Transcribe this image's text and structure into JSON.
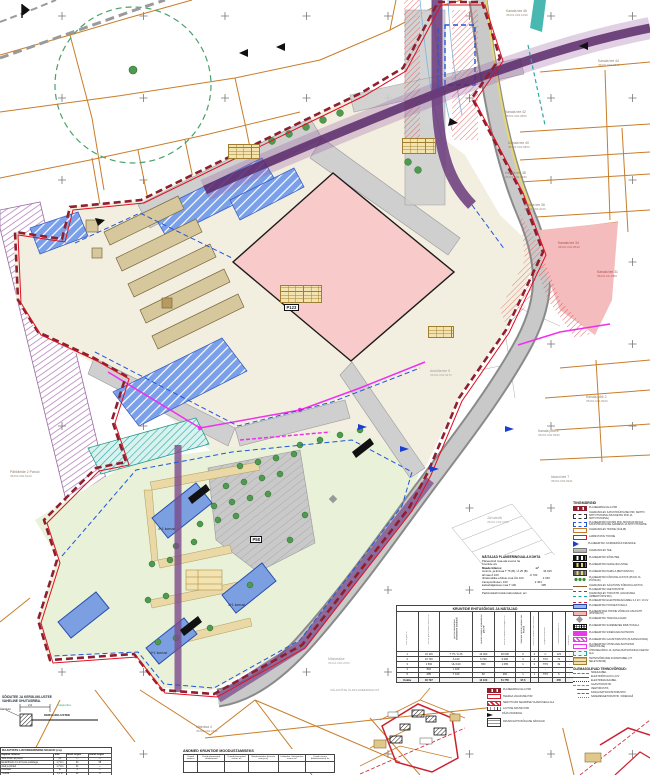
{
  "map": {
    "north_label": "s",
    "parcel_labels": [
      {
        "text": "Kanala tee 46",
        "sub": "35201:004:1090",
        "x": 506,
        "y": 10,
        "color": "#8a7a6a"
      },
      {
        "text": "Kanala tee 44",
        "sub": "35201:004:0870",
        "x": 598,
        "y": 60,
        "color": "#8a7a6a"
      },
      {
        "text": "Kanala tee 42",
        "sub": "35201:004:0850",
        "x": 505,
        "y": 111,
        "color": "#8a7a6a"
      },
      {
        "text": "Kanala tee 40",
        "sub": "35201:004:0860",
        "x": 508,
        "y": 142,
        "color": "#8a7a6a"
      },
      {
        "text": "Kanala tee 38",
        "sub": "35201:004:1580",
        "x": 505,
        "y": 172,
        "color": "#8a7a6a"
      },
      {
        "text": "Kanala tee 36",
        "sub": "35201:004:2020",
        "x": 524,
        "y": 204,
        "color": "#8a7a6a"
      },
      {
        "text": "Kanala tee 34",
        "sub": "35201:004:0540",
        "x": 558,
        "y": 242,
        "color": "#b05050"
      },
      {
        "text": "Kanala tee 31",
        "sub": "35201:06:1350",
        "x": 597,
        "y": 271,
        "color": "#b05050"
      },
      {
        "text": "Kanala põik 2",
        "sub": "35201:004:0920",
        "x": 586,
        "y": 396,
        "color": "#8a7a6a"
      },
      {
        "text": "Kanala põik 4",
        "sub": "35201:004:0930",
        "x": 538,
        "y": 430,
        "color": "#8a7a6a"
      },
      {
        "text": "Iduoru tee 7",
        "sub": "35201:004:0941",
        "x": 551,
        "y": 476,
        "color": "#8a7a6a"
      },
      {
        "text": "Jüri alevik",
        "sub": "35201:004:0150",
        "x": 487,
        "y": 517,
        "color": "#999"
      },
      {
        "text": "Aruküla tee 5",
        "sub": "35201:004:0273",
        "x": 430,
        "y": 370,
        "color": "#999"
      },
      {
        "text": "Pähklimäe 2 Parool",
        "sub": "35201:004:0120",
        "x": 10,
        "y": 471,
        "color": "#8a7a6a"
      },
      {
        "text": "Mäeotsa 4",
        "sub": "35201:004:0110",
        "x": 196,
        "y": 726,
        "color": "#8a7a6a"
      },
      {
        "text": "Mäepealse",
        "sub": "35201:004:2050",
        "x": 328,
        "y": 658,
        "color": "#999"
      }
    ],
    "area_labels": [
      {
        "text": "P123",
        "x": 284,
        "y": 304,
        "cls": "box"
      },
      {
        "text": "P58",
        "x": 250,
        "y": 536,
        "cls": "box"
      },
      {
        "text": "4+1 korrust",
        "x": 158,
        "y": 527
      },
      {
        "text": "4+1 korrust",
        "x": 228,
        "y": 603
      },
      {
        "text": "4+1 korrust",
        "x": 150,
        "y": 651
      }
    ],
    "inset_caption": "VÄLJAVÕTE ÜLDPLANEERINGUST"
  },
  "legend": {
    "title": "TINGMÄRGID",
    "entries": [
      {
        "symbol": "boundary",
        "label": "PLANEERINGUALA PIIR"
      },
      {
        "symbol": "cad-old",
        "label": "OLEMASOLEV KATASTRIÜKSUSE PIIR, KEHTIV SIHTOTSTARVE (MUUDETAV PIIR JA SIHTOTSTARVE)"
      },
      {
        "symbol": "cad-new",
        "label": "PLANEERITAV KRUNDI PIIR, MOODUSTATAVA KATASTRIÜKSUSE AADRESS JA SIHTOTSTARVE"
      },
      {
        "symbol": "bldg-old",
        "label": "OLEMASOLEV HOONE (SÄILIB)"
      },
      {
        "symbol": "bldg-dem",
        "label": "LAMMUTATAV HOONE"
      },
      {
        "symbol": "entrance",
        "label": "PLANEERITAV JUURDEPÄÄS KRUNDILE"
      },
      {
        "symbol": "road-old",
        "label": "OLEMASOLEV TEE"
      },
      {
        "symbol": "road-new",
        "label": "PLANEERITAV SÕIDUTEE"
      },
      {
        "symbol": "road-lk",
        "label": "PLANEERITAV KERGLIIKLUSTEE"
      },
      {
        "symbol": "road-park",
        "label": "PLANEERITAV PARKLA (BETOONKIVI)"
      },
      {
        "symbol": "trees",
        "label": "PLANEERITAV KÕRGHALJASTUS (PUUD JA PÕÕSAD)"
      },
      {
        "symbol": "tree-old",
        "label": "OLEMASOLEV SÄILITATAV KÕRGHALJASTUS"
      },
      {
        "symbol": "water",
        "label": "PLANEERITAV VEETORUSTIK"
      },
      {
        "symbol": "sewer",
        "label": "OLEMASOLEV TORUSTIK (VAJADUSEL ÜMBERTÕSTETAV)"
      },
      {
        "symbol": "elec",
        "label": "PLANEERITAV ELEKTRIMAAKAABEL 0,4 kV / 10 kV"
      },
      {
        "symbol": "buildarea",
        "label": "PLANEERITAV HOONESTUSALA"
      },
      {
        "symbol": "bldg-new",
        "label": "PLANEERITAVA HOONE VÕIMALIK ASUKOHT (PÕHIMAHT)"
      },
      {
        "symbol": "trafo",
        "label": "PLANEERITAV TRAFOALAJAAM"
      },
      {
        "symbol": "grid",
        "label": "PLANEERITAV SADEMEVEE IMMUTUSALA"
      },
      {
        "symbol": "mag1",
        "label": "PLANEERITAV SIDEKANALISATSIOON"
      },
      {
        "symbol": "mag2",
        "label": "PLANEERITAV GAASITORUSTIK (B-KATEGOORIA)"
      },
      {
        "symbol": "mag3",
        "label": "PLANEERITAV ÜHISKANALISATSIOON (ISEVOOLNE)"
      },
      {
        "symbol": "teal-area",
        "label": "ÜHISVEEVÄRGI JA -KANALISATSIOONIGA KAETAV ALA"
      },
      {
        "symbol": "note",
        "label": "TEHNOVÕRKUDE KOONDTABEL (VT SELETUSKIRI)"
      }
    ],
    "utilities_title": "OLEMASOLEVAD TEHNOVÕRGUD:",
    "utility_lines": [
      {
        "style": "l1",
        "label": "SIDEKAABEL"
      },
      {
        "style": "l2",
        "label": "ELEKTRIÕHULIIN 0,4 kV"
      },
      {
        "style": "l3",
        "label": "ELEKTRIMAAKAABEL"
      },
      {
        "style": "l4",
        "label": "GAASITORUSTIK"
      },
      {
        "style": "l5",
        "label": "VEETORUSTIK"
      },
      {
        "style": "l6",
        "label": "KANALISATSIOONITORUSTIK"
      },
      {
        "style": "l7",
        "label": "SADEMEVEETORUSTIK / DRENAAŽ"
      }
    ]
  },
  "legend2": {
    "entries": [
      {
        "symbol": "boundary",
        "label": "PLANEERINGUALA PIIR"
      },
      {
        "symbol": "road-red",
        "label": "TEEMAA VAJADUSE PIIR"
      },
      {
        "symbol": "servituut",
        "label": "SERVITUUDI SEADMISE VAJADUSEGA ALA"
      },
      {
        "symbol": "ticks",
        "label": "AJUTISE KRUNDI PIIR"
      },
      {
        "symbol": "arrow",
        "label": "PÄÄS KRUNDILE"
      },
      {
        "symbol": "notebox",
        "label": "KRUNDI EHITUSÕIGUSE NÄITAJAD"
      }
    ]
  },
  "indicators": {
    "title": "NÄITAJAD PLANEERINGUALA KOHTA",
    "lines": [
      [
        "Planeeritud maa-ala suurus ha",
        "1,2"
      ],
      [
        "Kruntide arv",
        "1"
      ]
    ],
    "head": [
      "Maade bilanss:",
      "m²",
      "%"
    ],
    "rows": [
      [
        "tootmis- ja ärimaa T 75 (B) / Ä 25 (B)",
        "34 915",
        "92"
      ],
      [
        "ärimaa Ä 100",
        "-6 700",
        "-"
      ],
      [
        "ühiskondlike ehitiste maa ÜH 100",
        "2 160",
        "7"
      ],
      [
        "transpordimaa L 100",
        "2 404",
        "1"
      ],
      [
        "kaitsehaljastuse maa T 100",
        "395",
        "1"
      ]
    ],
    "footer": [
      "Parkimiskohti kokku lahendatud, arv",
      "31"
    ]
  },
  "main_table": {
    "title": "KRUNTIDE EHITUSÕIGUS JA NÄITAJAD",
    "col_headers": [
      "Krundi pos nr",
      "Krundi planeeritud suurus m²",
      "Krundi kasutamise sihtotstarve (osakaal)",
      "Suurim lubatud ehitisealune pind m²",
      "Suurim lubatud brutopind m²",
      "Hoonete suurim lubatud arv krundil",
      "Suurim lubatud korruselisus",
      "Tulepüsivusklass",
      "Parkimiskohtade arv",
      "Märkused"
    ],
    "rows": [
      [
        "1",
        "24 115",
        "T 75 / Ä 25",
        "13 000",
        "30 000",
        "6",
        "3",
        "C",
        "123",
        "-"
      ],
      [
        "2",
        "10 720",
        "Ä 100",
        "6 720",
        "9 000",
        "3",
        "2",
        "TP2",
        "71",
        "-"
      ],
      [
        "3",
        "1 560",
        "ÜH 100",
        "650",
        "1 055",
        "1",
        "3",
        "TP3",
        "32",
        "-"
      ],
      [
        "4",
        "804",
        "L 100",
        "-",
        "-",
        "-",
        "-",
        "-",
        "-",
        "-"
      ],
      [
        "5",
        "685",
        "T 100",
        "60",
        "200",
        "1",
        "1",
        "TP3",
        "6",
        "-"
      ]
    ],
    "total": [
      "Kokku",
      "36 797",
      "",
      "13 100",
      "51 755",
      "97,6",
      "",
      "",
      "365",
      ""
    ]
  },
  "bottom_left": {
    "heading1": "SÕIDUTEE JA KERGLIIKLUSTEE",
    "heading2": "VAHELINE OHUTUSRIBA.",
    "diagram": {
      "dim": "2,0",
      "left_label": "Äärekivi",
      "right_label": "KERGLIIKLUSTEE",
      "top_label": "haljasriba"
    },
    "table": {
      "title": "RAJATISTE LIKVIDEERIMISE MAHUD (ca)",
      "col_headers": [
        "Rajatise nimetus",
        "ühik",
        "likvid. kogus",
        "asend. kogus"
      ],
      "rows": [
        [
          "Side õhuliin ja postid",
          "jm",
          "—",
          "—"
        ],
        [
          "Elektriõhuliin 0,4 kV koos postidega",
          "1,7 km",
          "24",
          "58"
        ],
        [
          "Aiad ja piirded",
          "1,7 km",
          "21",
          "—"
        ],
        [
          "Puurkaev",
          "tk",
          "1",
          "—"
        ],
        [
          "Truubid",
          "1,1 m",
          "12",
          "8"
        ],
        [
          "Jalgteed, killustikkate",
          "m²",
          "—",
          "31"
        ]
      ],
      "total": [
        "KOKKU",
        "",
        "",
        "126"
      ]
    }
  },
  "andmed_table": {
    "title": "ANDMED KRUNTIDE MOODUSTAMISEKS",
    "col_headers": [
      "Krundi aadress",
      "Krundi planeeritud sihtotstarved",
      "Krundi planeeritud suurus m²",
      "Moodustatakse (kinnistu nimi ja nr)",
      "Liidetakse / lahutatakse suurus m²",
      "Osade suurus (lähtekinnistust) ha"
    ]
  }
}
